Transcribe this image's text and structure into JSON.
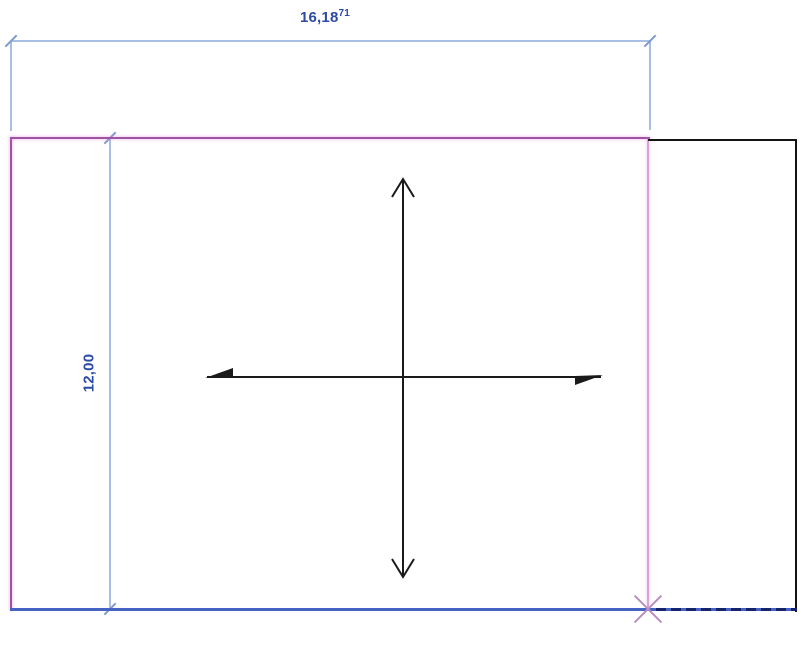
{
  "canvas": {
    "width": 800,
    "height": 646,
    "background": "#FFFFFF"
  },
  "dimensions": {
    "width_dim": {
      "value": "16,18",
      "superscript": "71"
    },
    "height_dim": {
      "value": "12,00"
    }
  },
  "colors": {
    "canvas-bg": "#FFFFFF",
    "dim-text": "#2B4AA6",
    "dim-line": "#A9BEE5",
    "dim-tick": "#7D9AD0",
    "selected-stroke": "#9C56A0",
    "selected-stroke-light": "#DDA0DD",
    "marker-x": "#B98FC0",
    "model-line-blue": "#4663C4",
    "dash-navy": "#16246E",
    "model-line-black": "#141414",
    "axis-black": "#1A1A1A"
  },
  "icons": {
    "up_arrow": "open-arrowhead-up",
    "down_arrow": "open-arrowhead-down",
    "left_half_arrow": "filled-half-arrowhead-left",
    "right_half_arrow": "filled-half-arrowhead-right",
    "dim_tick": "slash-tick",
    "endpoint": "x-marker"
  }
}
